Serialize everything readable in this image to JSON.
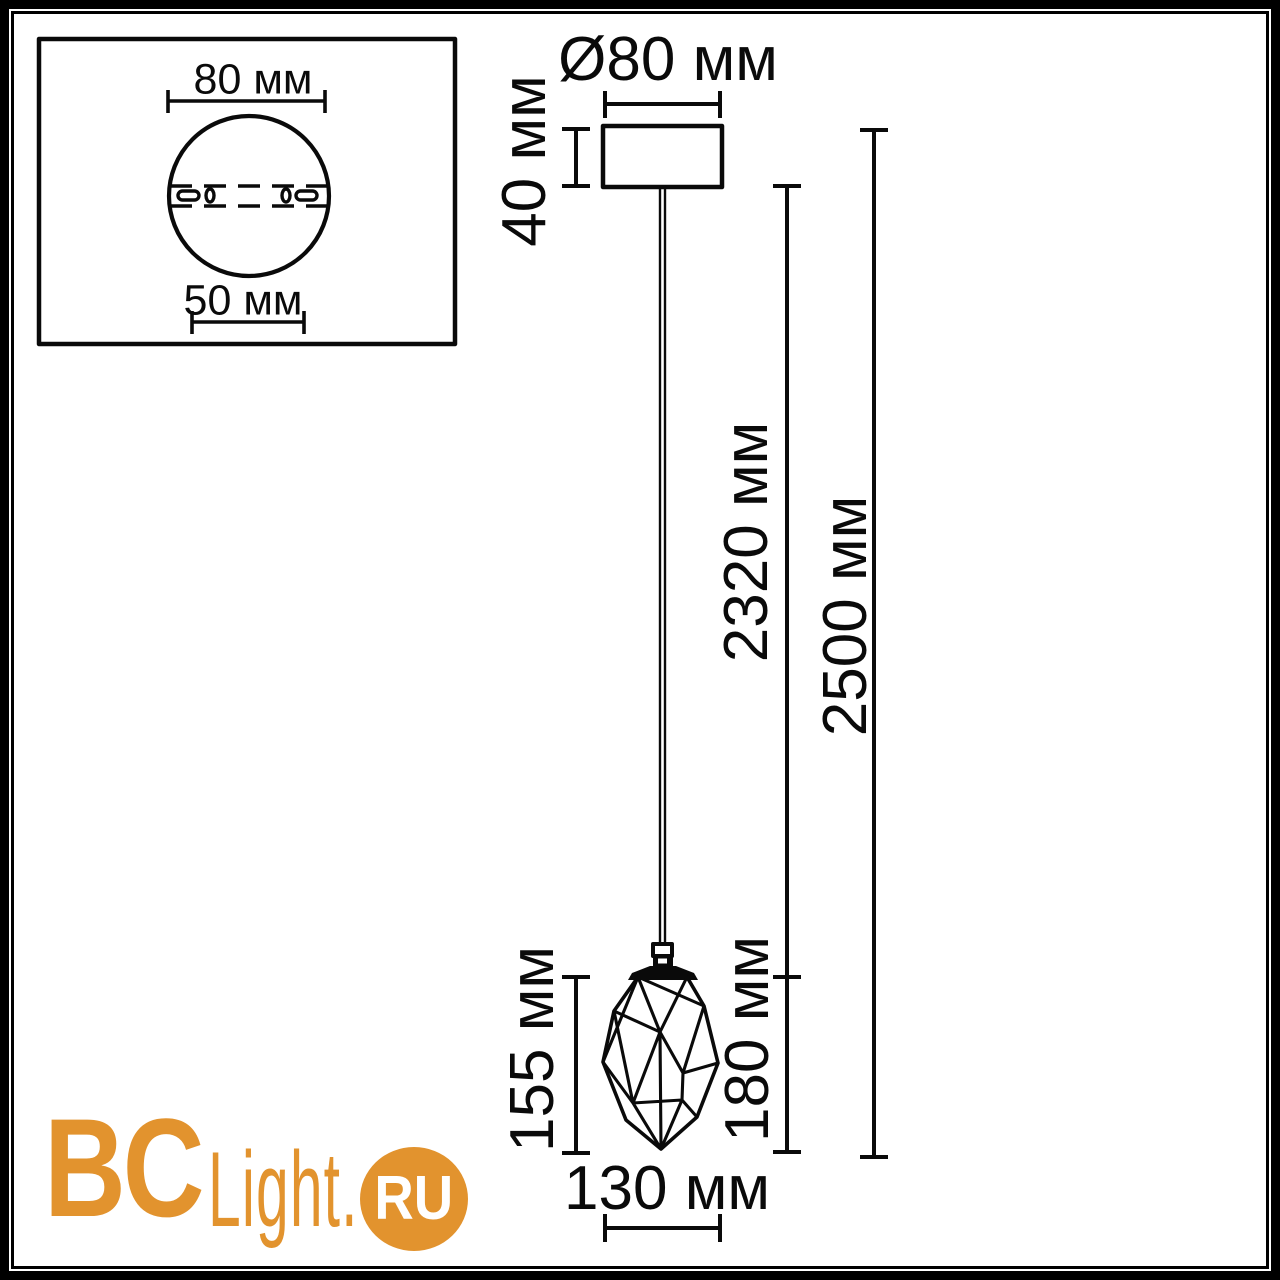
{
  "page": {
    "background_color": "#FFFFFF",
    "line_color": "#0A0A0A"
  },
  "inset_view": {
    "description": "ceiling-canopy-bottom-view",
    "outer_diameter_label": "80 мм",
    "mount_hole_spacing_label": "50 мм"
  },
  "pendant_view": {
    "canopy_diameter_label": "Ø80 мм",
    "canopy_height_label": "40 мм",
    "cord_length_label": "2320 мм",
    "total_height_label": "2500 мм",
    "shade_height_label": "155 мм",
    "shade_with_socket_height_label": "180 мм",
    "shade_width_label": "130 мм"
  },
  "watermark": {
    "brand_primary": "BC",
    "brand_secondary": "Light.",
    "brand_suffix": "RU",
    "accent_color": "#E2932E"
  }
}
